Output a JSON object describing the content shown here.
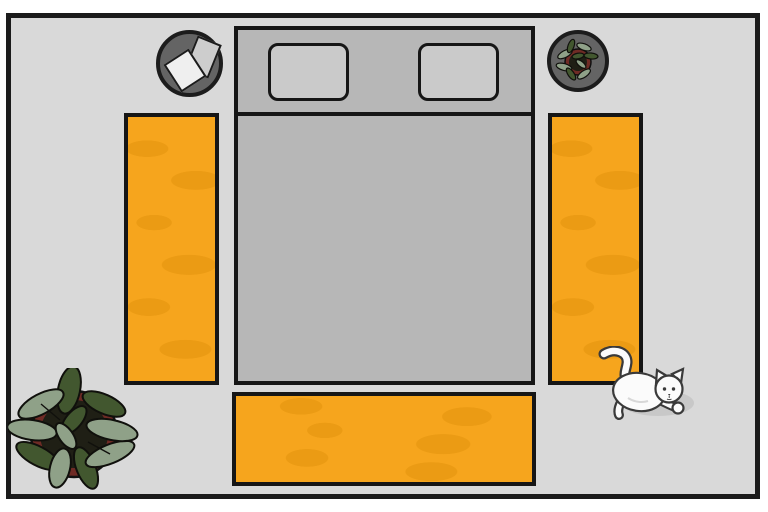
{
  "scene": {
    "name": "bedroom-floor-plan",
    "description": "Top-down illustration of a bedroom: a gray double bed with two pillows against the top wall, orange rugs on the left and right sides of the bed and at its foot, a round side table with papers at top-left of the bed, a round side table with a small potted plant at top-right, a large potted plant in the bottom-left corner of the room, and a white cat walking near the bottom-right corner of the right rug",
    "objects": [
      {
        "id": "room",
        "label": "bedroom floor"
      },
      {
        "id": "bed",
        "label": "double bed",
        "parts": [
          "headboard band",
          "pillow left",
          "pillow right",
          "mattress"
        ]
      },
      {
        "id": "rug-left",
        "label": "left bedside rug"
      },
      {
        "id": "rug-right",
        "label": "right bedside rug"
      },
      {
        "id": "rug-foot",
        "label": "rug at foot of bed"
      },
      {
        "id": "table-papers",
        "label": "round side table with two papers"
      },
      {
        "id": "table-plant",
        "label": "round side table with small potted plant"
      },
      {
        "id": "floor-plant",
        "label": "large potted plant, top view"
      },
      {
        "id": "cat",
        "label": "white cat walking, top view"
      }
    ]
  },
  "colors": {
    "canvas": "#ffffff",
    "floor": "#d9d9d9",
    "wall": "#1b1b1b",
    "outline": "#161616",
    "bed": "#b7b7b7",
    "pillow": "#cacaca",
    "rug": "#f6a51d",
    "rug-texture": "#e2920c",
    "table": "#646464",
    "paper-back": "#cdcdcd",
    "paper-front": "#efefef",
    "pot-rim": "#6f2b25",
    "pot-soil": "#1f1f15",
    "leaf-dark": "#42572f",
    "leaf-light": "#8fa188",
    "cat-body": "#fbfbfb",
    "cat-outline": "#3a3a3a",
    "shadow": "#c2c2c2"
  }
}
